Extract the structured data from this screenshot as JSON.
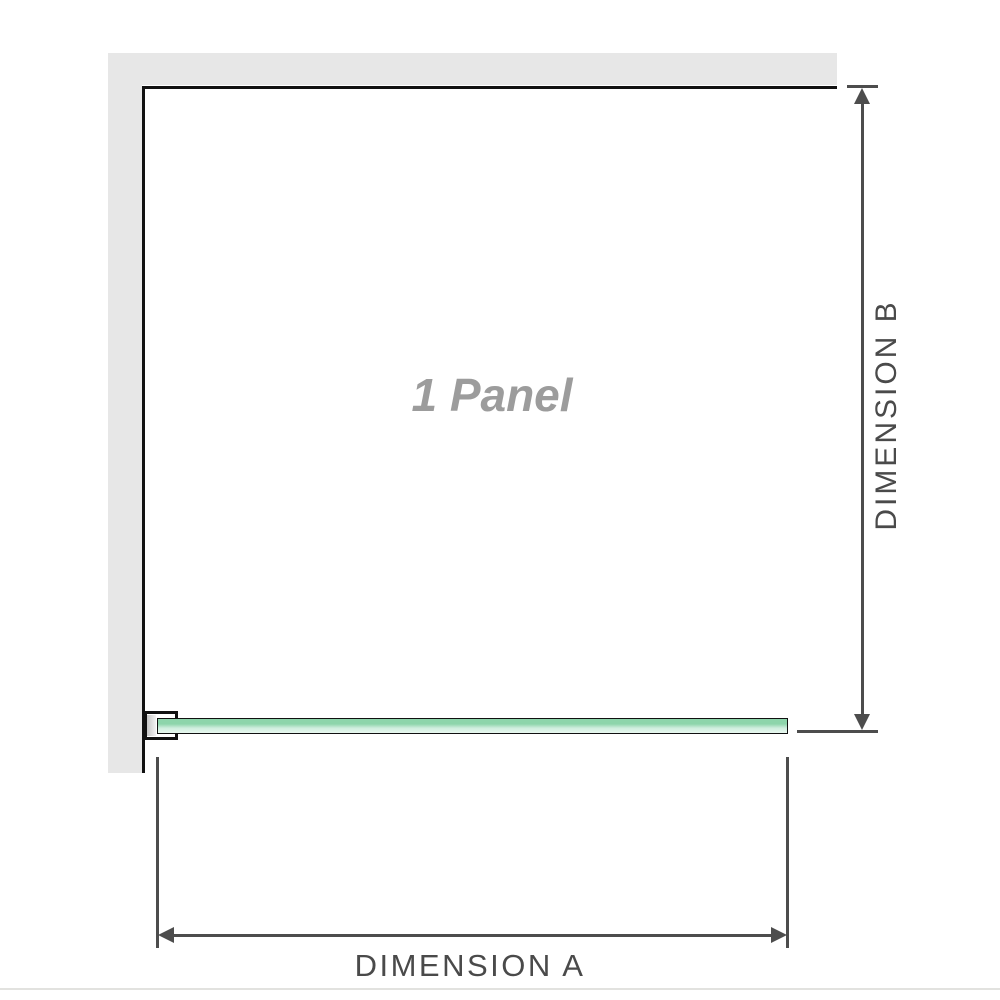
{
  "diagram": {
    "panel_label": "1 Panel",
    "dimensions": {
      "a_label": "DIMENSION A",
      "b_label": "DIMENSION B"
    }
  },
  "colors": {
    "wall": "#e7e7e7",
    "edge": "#111111",
    "line": "#4d4d4d",
    "dim-text": "#4a4a4a",
    "panel-text": "#9c9c9c",
    "glass-dark": "#8dd5ab",
    "glass-mid": "#cfeede",
    "glass-light": "#e9f8f0",
    "bracket-plate-dark": "#c6c6c6",
    "bracket-plate-light": "#f2f2f2",
    "baseline": "#e2e2df"
  }
}
